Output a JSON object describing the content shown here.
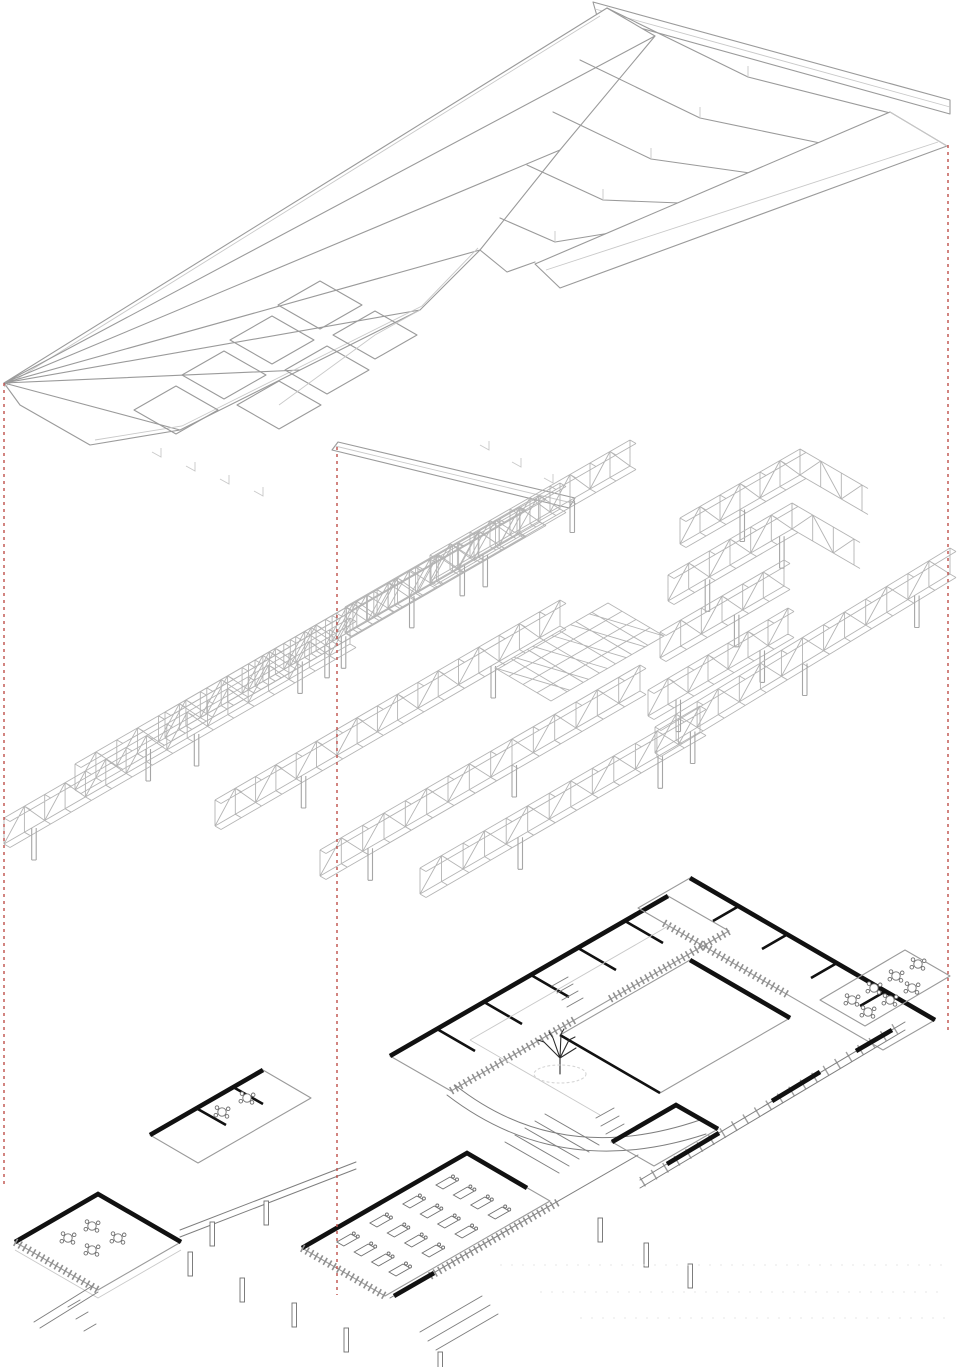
{
  "drawing": {
    "type": "exploded-axonometric",
    "background": "#ffffff"
  },
  "colors": {
    "background": "#ffffff",
    "linework": "#9a9a9a",
    "linework_strong": "#7e7e7e",
    "poche": "#111111",
    "guide": "#bf4f4a"
  },
  "layers": [
    {
      "id": "roof",
      "name": "Folded plate roof",
      "order": 1
    },
    {
      "id": "structure",
      "name": "Space-frame truss structure",
      "order": 2
    },
    {
      "id": "ground",
      "name": "Ground level with courtyards",
      "order": 3
    }
  ],
  "guides": [
    {
      "x": 4,
      "y1": 383,
      "y2": 1185
    },
    {
      "x": 337,
      "y1": 447,
      "y2": 1295
    },
    {
      "x": 948,
      "y1": 145,
      "y2": 1032
    }
  ]
}
